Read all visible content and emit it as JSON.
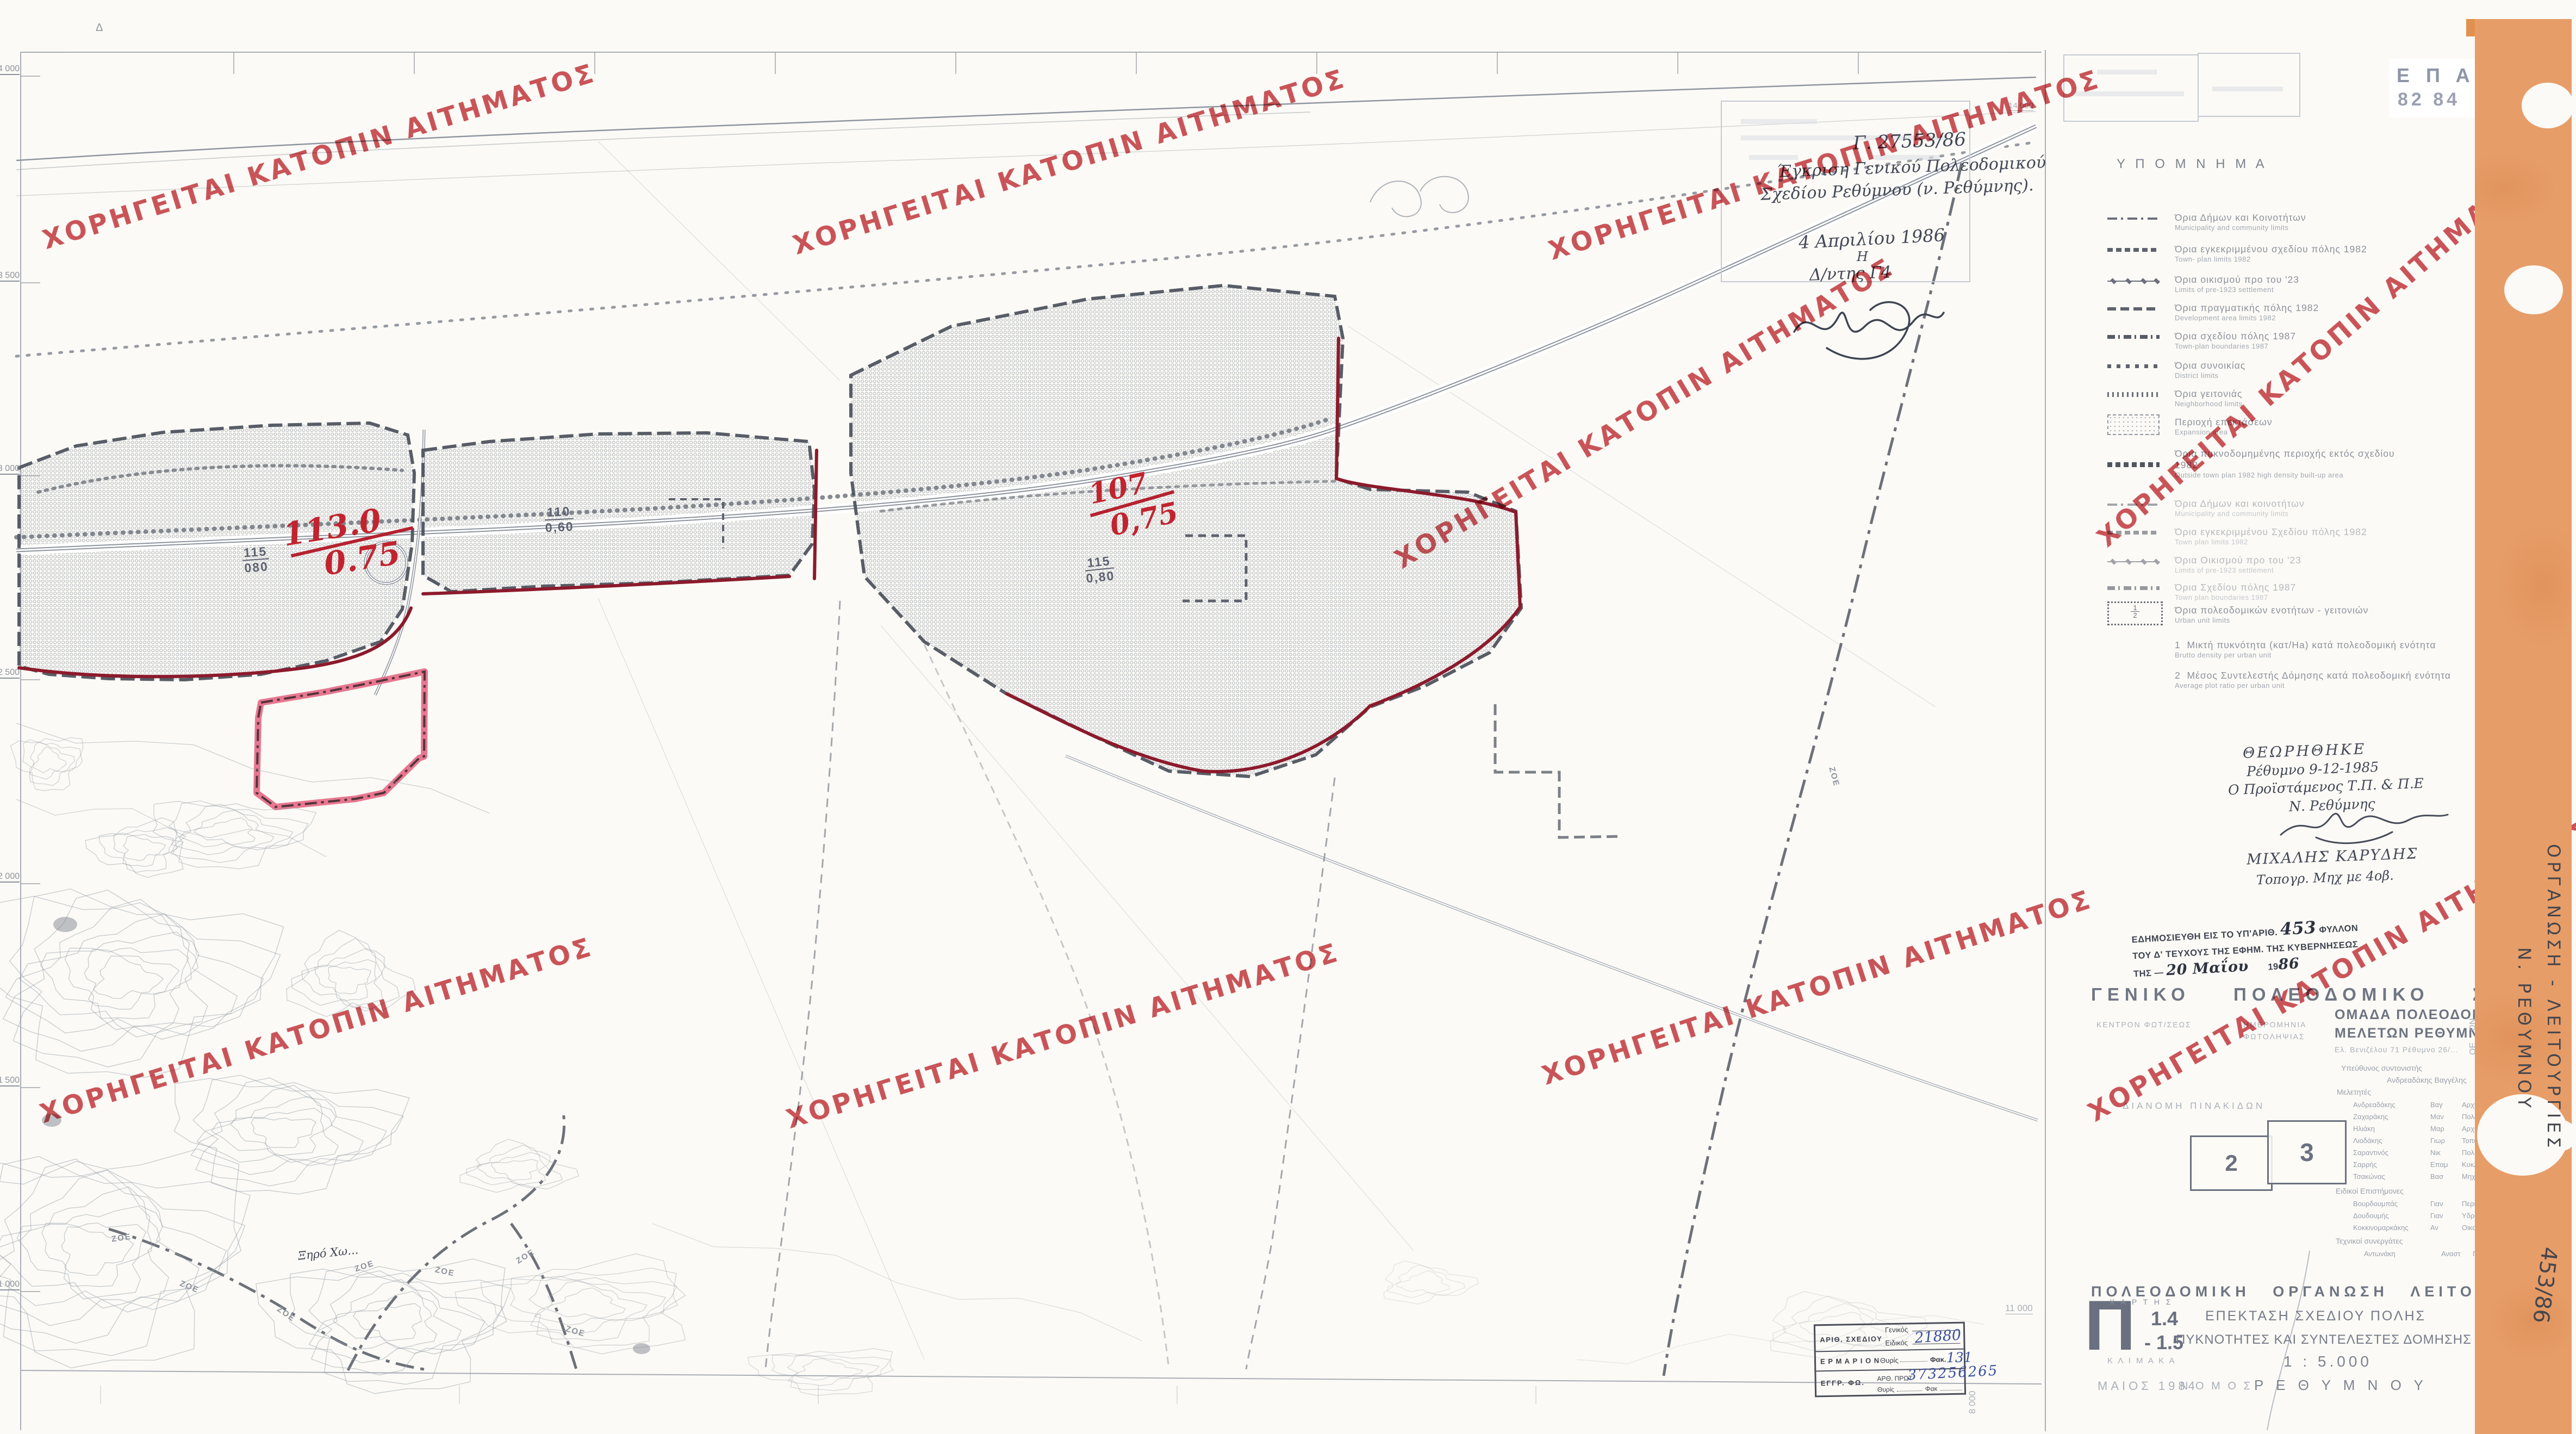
{
  "watermark": {
    "text": "ΧΟΡΗΓΕΙΤΑΙ ΚΑΤΟΠΙΝ ΑΙΤΗΜΑΤΟΣ"
  },
  "epa": {
    "line1": "Ε Π Α",
    "line2": "82 84"
  },
  "legend": {
    "title": "Υ Π Ο Μ Ν Η Μ Α",
    "items": [
      {
        "gr": "Όρια Δήμων και Κοινοτήτων",
        "en": "Municipality and community limits"
      },
      {
        "gr": "Όρια εγκεκριμμένου σχεδίου πόλης 1982",
        "en": "Town- plan limits 1982"
      },
      {
        "gr": "Όρια οικισμού προ του '23",
        "en": "Limits of pre-1923 settlement"
      },
      {
        "gr": "Όρια πραγματικής πόλης 1982",
        "en": "Development area limits 1982"
      },
      {
        "gr": "Όρια σχεδίου πόλης 1987",
        "en": "Town-plan boundaries 1987"
      },
      {
        "gr": "Όρια συνοικίας",
        "en": "District limits"
      },
      {
        "gr": "Όρια γειτονιάς",
        "en": "Neighborhood limits"
      },
      {
        "gr": "Περιοχή επεκτάσεων",
        "en": "Expansion area"
      },
      {
        "gr": "Όρια πυκνοδομημένης περιοχής εκτός σχεδίου 1982",
        "en": "Outside town plan 1982 high density built-up area"
      },
      {
        "gr": "Όρια Δήμων και κοινοτήτων",
        "en": "Municipality and community limits"
      },
      {
        "gr": "Όρια εγκεκριμμένου Σχεδίου πόλης 1982",
        "en": "Town plan limits 1982"
      },
      {
        "gr": "Όρια Οικισμού προ του '23",
        "en": "Limits of pre-1923 settlement"
      },
      {
        "gr": "Όρια Σχεδίου πόλης 1987",
        "en": "Town plan boundaries 1987"
      },
      {
        "gr": "Όρια πολεοδομικών ενοτήτων - γειτονιών",
        "en": "Urban unit limits",
        "frac_top": "1",
        "frac_bottom": "2"
      }
    ],
    "notes": [
      {
        "num": "1",
        "gr": "Μικτή πυκνότητα (κατ/Ha) κατά πολεοδομική ενότητα",
        "en": "Brutto density per urban unit"
      },
      {
        "num": "2",
        "gr": "Μέσος Συντελεστής Δόμησης κατά πολεοδομική ενότητα",
        "en": "Average plot ratio per urban unit"
      }
    ]
  },
  "approval_note": {
    "ref": "Γ. 27553/86",
    "line1": "Έγκριση Γενικού Πολεοδομικού",
    "line2": "Σχεδίου Ρεθύμνου (ν. Ρεθύμνης).",
    "date": "4 Απριλίου 1986",
    "article": "Η",
    "role": "Δ/ντης Γ4"
  },
  "endorsement": {
    "line1": "ΘΕΩΡΗΘΗΚΕ",
    "line2": "Ρέθυμνο 9-12-1985",
    "line3": "Ο Προϊστάμενος Τ.Π. & Π.Ε",
    "line4": "Ν. Ρεθύμνης",
    "name": "ΜΙΧΑΛΗΣ ΚΑΡΥΔΗΣ",
    "title": "Τοπογρ. Μηχ με 4οβ."
  },
  "gazette": {
    "l1a": "ΕΔΗΜΟΣΙΕΥΘΗ ΕΙΣ ΤΟ ΥΠ'ΑΡΙΘ.",
    "number": "453",
    "l1b": "ΦΥΛΛΟΝ",
    "l2": "ΤΟΥ Δ' ΤΕΥΧΟΥΣ ΤΗΣ ΕΦΗΜ. ΤΗΣ ΚΥΒΕΡΝΗΣΕΩΣ",
    "l3a": "ΤΗΣ —",
    "date_hand": "20 Μαΐου",
    "cent": "19",
    "year_hand": "86"
  },
  "gps_title": "ΓΕΝΙΚΟ ΠΟΛΕΟΔΟΜΙΚΟ ΣΧΕΔΙΟ",
  "photo_block": {
    "l1": "ΚΕΝΤΡΟΝ ΦΩΤ/ΣΕΩΣ",
    "l2": "ΗΜΕΡΟΜΗΝΙΑ",
    "l3": "ΦΩΤΟΛΗΨΙΑΣ",
    "l4": "ΔΙΑΝΟΜΗ ΠΙΝΑΚΙΔΩΝ"
  },
  "index_map": {
    "sheet2": "2",
    "sheet3": "3"
  },
  "team": {
    "org1": "ΟΜΑΔΑ ΠΟΛΕΟΔΟΜΙΚΩΝ",
    "org2": "ΜΕΛΕΤΩΝ ΡΕΘΥΜΝΟΥ ΟΕ",
    "address": "Ελ. Βενιζέλου 71  Ρέθυμνο 26/...",
    "coord_label": "Υπεύθυνος συντονιστής",
    "coordinator": "Ανδρεαδάκης Βαγγέλης",
    "members_label": "Μελετητές",
    "members": [
      [
        "Ανδρεαδάκης",
        "Βαγ",
        "Αρχιτέκ"
      ],
      [
        "Ζαχαράκης",
        "Μαν",
        "Πολεοδ"
      ],
      [
        "Ηλιάκη",
        "Μαρ",
        "Αρχιτέκ"
      ],
      [
        "Λιοδάκης",
        "Γιωρ",
        "Τοπογραφ"
      ],
      [
        "Σαραντινός",
        "Νικ",
        "Πολ Μηχ"
      ],
      [
        "Σαρρής",
        "Επαμ",
        "Κυκλοφ"
      ],
      [
        "Τσακώνας",
        "Βασ",
        "Μηχανολ"
      ]
    ],
    "spec_label": "Ειδικοί Επιστήμονες",
    "specialists": [
      [
        "Βουρδουμπάς",
        "Γιαν",
        "Περιβ Μηχ"
      ],
      [
        "Δουδουμής",
        "Γιαν",
        "Υδραυλ Μηχ"
      ],
      [
        "Κοκκινομαρκάκης",
        "Αν",
        "Οικονομολ"
      ]
    ],
    "assist_label": "Τεχνικοί συνεργάτες",
    "assistants": [
      [
        "Αντωνάκη",
        "Αναστ",
        "Γραμματ"
      ]
    ]
  },
  "title_block": {
    "title": "ΠΟΛΕΟΔΟΜΙΚΗ  ΟΡΓΑΝΩΣΗ  ΛΕΙΤΟΥΡΓΙΕΣ",
    "map_letter": "Π",
    "chart_label": "Χ Α Ρ Τ Η Σ",
    "sheet1": "1.4",
    "sheet2": "- 1.5",
    "subtitle1": "ΕΠΕΚΤΑΣΗ ΣΧΕΔΙΟΥ ΠΟΛΗΣ",
    "subtitle2": "ΠΥΚΝΟΤΗΤΕΣ ΚΑΙ ΣΥΝΤΕΛΕΣΤΕΣ ΔΟΜΗΣΗΣ",
    "scale_label": "Κ Λ Ι Μ Α Κ Α",
    "scale": "1 : 5.000",
    "date": "ΜΑΙΟΣ 1984",
    "nomos": "Ν Ο Μ Ο Σ",
    "nomos_value": "Ρ Ε Θ Υ Μ Ν Ο Υ"
  },
  "drawing_stamp": {
    "r1a": "ΑΡΙΘ. ΣΧΕΔΙΟΥ",
    "genikos": "Γενικός",
    "eidikos": "Ειδικός",
    "eidikos_value": "21880",
    "r2a": "Ε Ρ Μ Α Ρ Ι Ο Ν",
    "thyris": "Θυρίς",
    "fak": "Φακ.",
    "fak_value": "131",
    "r3a": "ΕΓΓΡ. ΦΩ.",
    "prot": "ΑΡΘ. ΠΡΩΤ",
    "prot_value": "373256265",
    "thyris2": "Θυρίς",
    "fak2": "Φακ"
  },
  "side_strip": {
    "line1": "ΟΡΓΑΝΩΣΗ - ΛΕΙΤΟΥΡΓΙΕΣ",
    "line2": "Ν. ΡΕΘΥΜΝΟΥ",
    "file_no": "453/86",
    "frag1": "ΩΝ",
    "frag2": "ΟΕ"
  },
  "map": {
    "red_fractions": [
      {
        "top": "113.0",
        "bottom": "0.75"
      },
      {
        "top": "107",
        "bottom": "0,75"
      }
    ],
    "density_labels": [
      {
        "top": "115",
        "bottom": "080"
      },
      {
        "top": "110",
        "bottom": "0,60"
      },
      {
        "top": "115",
        "bottom": "0,80"
      }
    ],
    "zoe_label": "ΖΟΕ",
    "place_label": "Ξηρό Χω...",
    "corner_mark": "Δ",
    "grid_left": [
      "14 000",
      "13 500",
      "13 000",
      "12 500",
      "12 000",
      "11 500",
      "11 000"
    ],
    "grid_right_top": "14 000",
    "grid_br_h": "11 000",
    "grid_br_v": "8 000"
  },
  "colors": {
    "stamp_red": "#c4373e",
    "boundary_wine": "#8c1a2c",
    "pink": "#e25677",
    "orange": "#e79d68",
    "hand_blue": "#3a4f9e"
  }
}
